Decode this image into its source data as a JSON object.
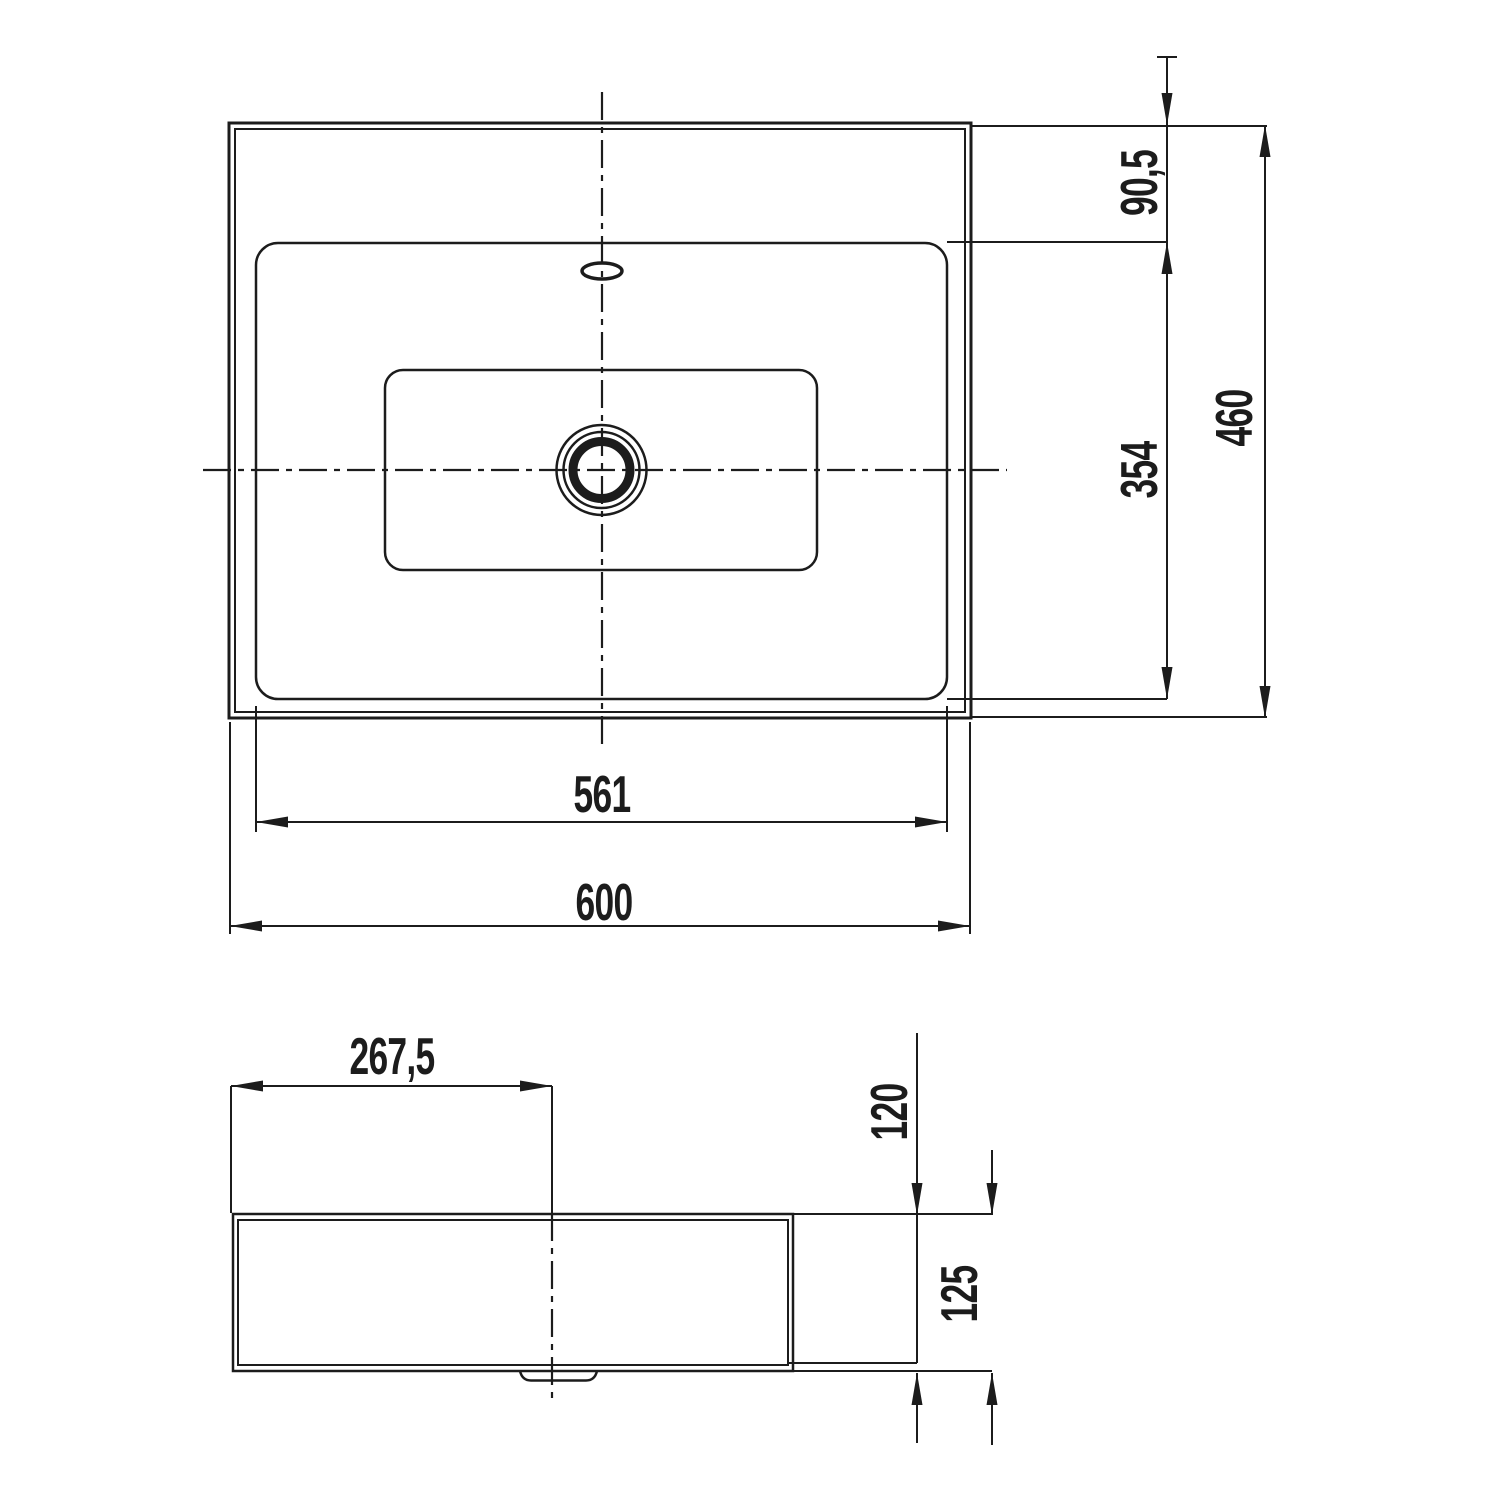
{
  "drawing_title": "washbasin-dimension-drawing",
  "colors": {
    "line": "#1c1c1c",
    "background": "#ffffff"
  },
  "views": {
    "top": {
      "width_overall": "600",
      "width_basin": "561",
      "depth_overall": "460",
      "depth_basin": "354",
      "rear_deck_offset": "90,5"
    },
    "side": {
      "drain_center_offset": "267,5",
      "height_deck": "120",
      "height_overall": "125"
    }
  }
}
